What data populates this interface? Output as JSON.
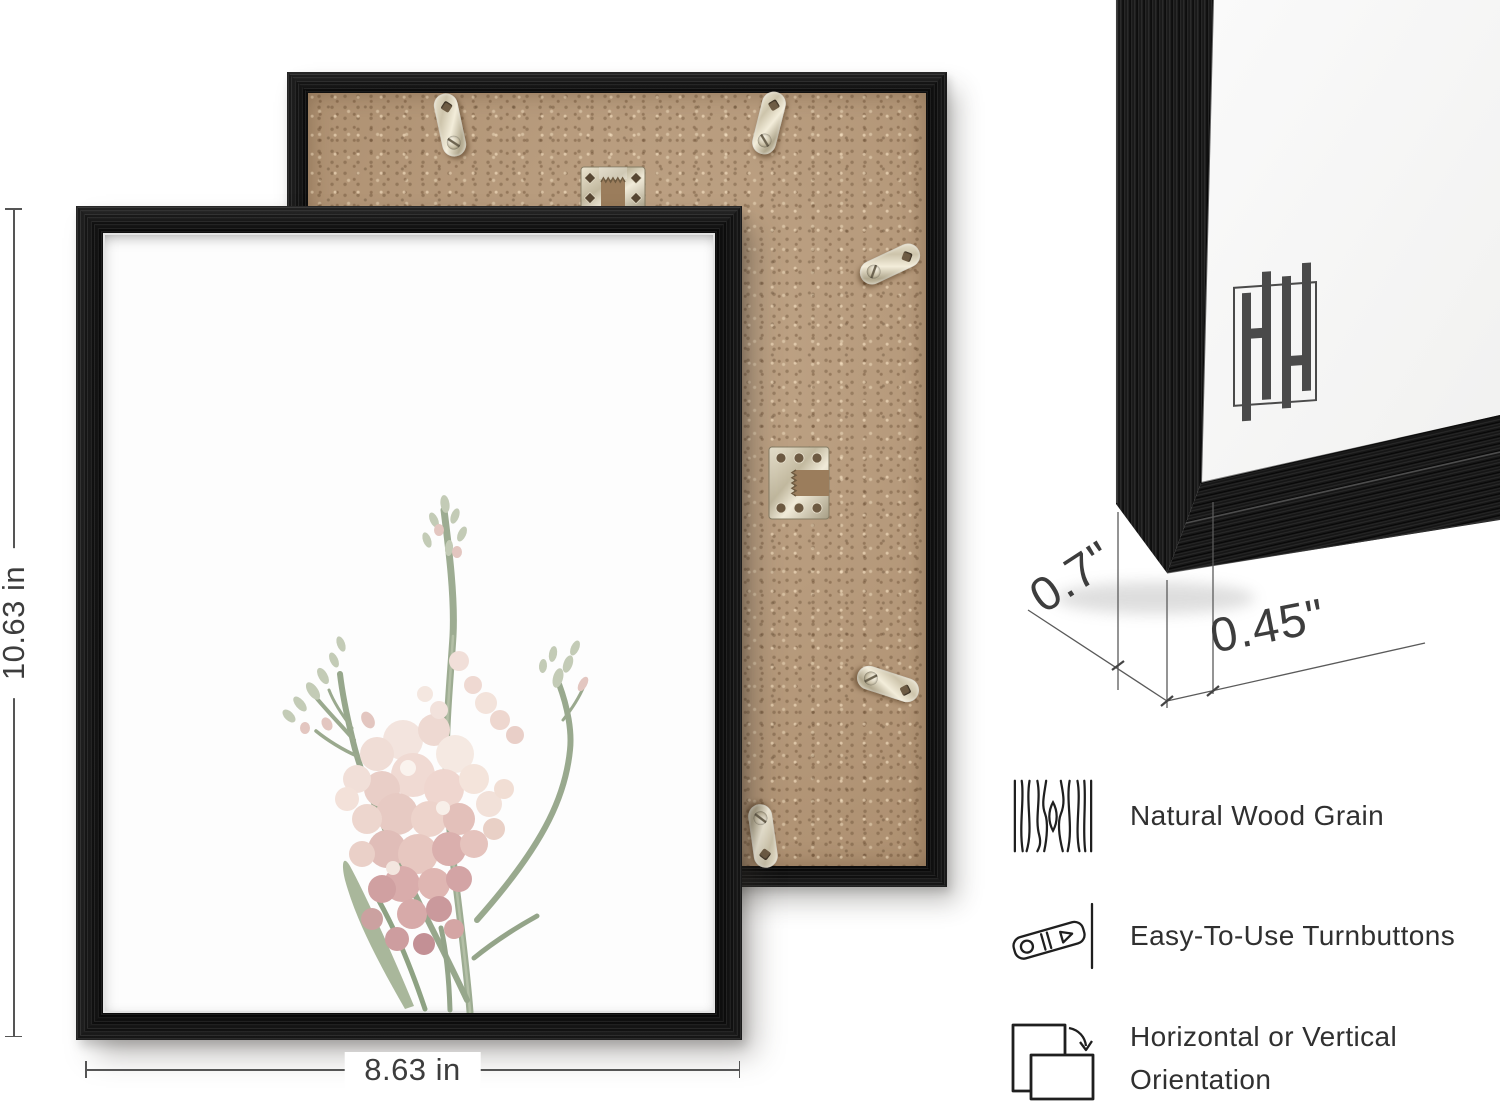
{
  "canvas": {
    "width": 1500,
    "height": 1110
  },
  "colors": {
    "background": "#ffffff",
    "frame_black": "#161616",
    "mdf_tan": "#b69878",
    "metal_silver": "#cfc6ad",
    "text_dark": "#303030",
    "dim_text": "#3d3d3d",
    "stem_green": "#9dac92",
    "blossom_pink": "#ecd3cd",
    "logo_gray": "#4a4a4a"
  },
  "front_frame": {
    "height_label": "10.63 in",
    "width_label": "8.63 in",
    "art_description": "pale pink wildflower print"
  },
  "back_frame": {
    "hardware": [
      "sawtooth-hanger-portrait",
      "sawtooth-hanger-landscape",
      "turnbutton",
      "turnbutton",
      "turnbutton",
      "turnbutton",
      "turnbutton"
    ]
  },
  "corner_view": {
    "depth_label": "0.7\"",
    "moulding_width_label": "0.45\"",
    "logo_text": "HH"
  },
  "features": [
    {
      "icon": "wood-grain-icon",
      "label": "Natural Wood Grain"
    },
    {
      "icon": "turnbutton-icon",
      "label": "Easy-To-Use Turnbuttons"
    },
    {
      "icon": "orientation-icon",
      "label": "Horizontal or Vertical Orientation"
    }
  ]
}
